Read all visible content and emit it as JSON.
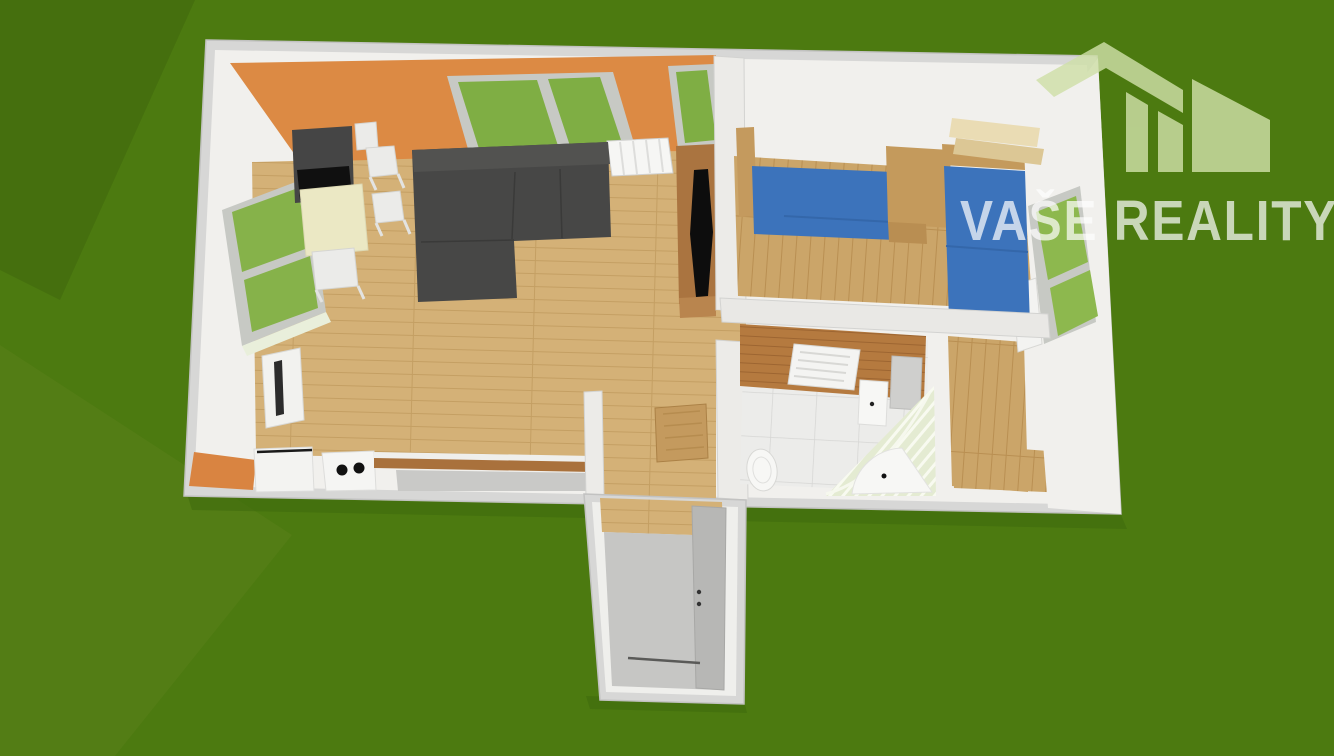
{
  "watermark": {
    "text": "VAŠE REALITY",
    "logo": "house-roofs-logo",
    "text_color": "#ffffff",
    "logo_color": "#cfe0a8"
  },
  "palette": {
    "background_green": "#4c7a10",
    "background_green_dark": "#456f0e",
    "background_green_light": "#537d15",
    "wall_outer_gray": "#d7d7d6",
    "wall_white": "#f1f0ed",
    "accent_wall_orange": "#dc8a44",
    "window_glass_green": "#7fae44",
    "floor_wood_light": "#d4b177",
    "floor_wood_bedroom": "#cba569",
    "bath_wood_wall": "#b57a3f",
    "sofa_dark_gray": "#474746",
    "wardrobe_dark_gray": "#454545",
    "bed_blue": "#3c73bb",
    "tv_cabinet_brown": "#aa7440",
    "dining_table_cream": "#ebe8c4",
    "tile_white": "#ececea",
    "corridor_floor_gray": "#c6c6c4",
    "entry_door_gray": "#b7b7b5"
  }
}
